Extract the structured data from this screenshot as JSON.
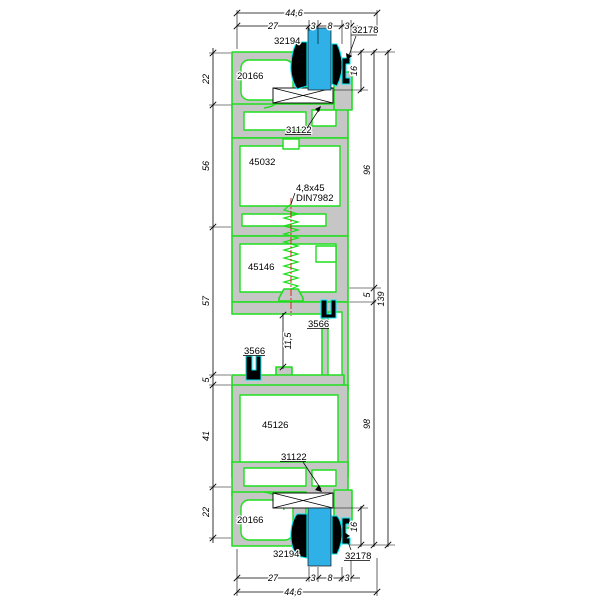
{
  "drawing": {
    "type": "technical-cross-section",
    "description": "Aluminium window profile vertical section with glazing, gaskets, screw and dimension chains",
    "colors": {
      "profile_outline": "#1fdd1f",
      "aluminum_fill": "#c6c6c6",
      "glass": "#2fb0e6",
      "gasket": "#000000",
      "gasket_outline": "#00e8f0",
      "centerline": "#dd1111",
      "dimension": "#000000",
      "background": "#ffffff"
    },
    "parts": {
      "frame_top": "20166",
      "frame_bottom": "20166",
      "sash_top": "45032",
      "mid": "45146",
      "sash_bottom": "45126",
      "gasket_top": "32194",
      "gasket_bottom": "32194",
      "clip_top": "32178",
      "clip_bottom": "32178",
      "bead_top": "31122",
      "bead_bottom": "31122",
      "clip_mid_right": "3566",
      "clip_mid_left": "3566",
      "screw_size": "4,8x45",
      "screw_din": "DIN7982"
    },
    "dims": {
      "top_total": "44,6",
      "top_seg27": "27",
      "top_seg3a": "3",
      "top_seg8": "8",
      "top_seg3b": "3",
      "left_22a": "22",
      "left_56": "56",
      "left_57": "57",
      "left_5": "5",
      "left_41": "41",
      "left_22b": "22",
      "right_16a": "16",
      "right_96": "96",
      "right_5": "5",
      "right_98": "98",
      "right_139": "139",
      "right_16b": "16",
      "mid_115": "11,5",
      "bot_seg27": "27",
      "bot_seg3a": "3",
      "bot_seg8": "8",
      "bot_seg3b": "3",
      "bot_total": "44,6"
    }
  }
}
